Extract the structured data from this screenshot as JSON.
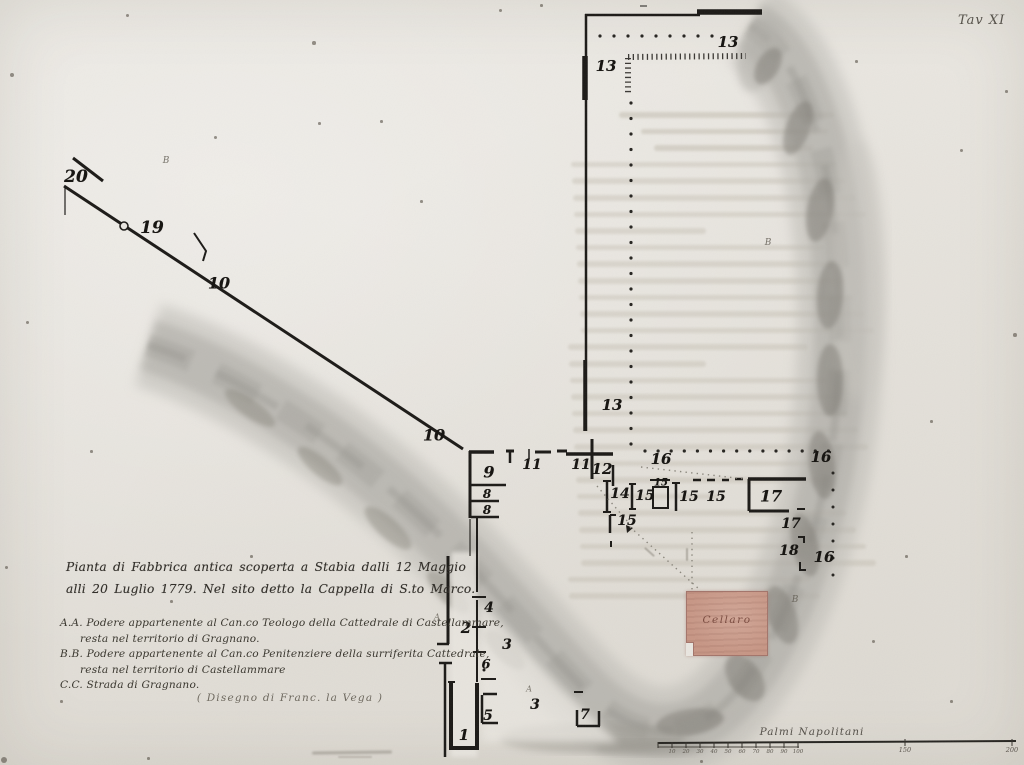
{
  "page": {
    "plate_label": "Tav XI"
  },
  "title_block": {
    "caption_lines": [
      "Pianta di Fabbrica antica scoperta a Stabia dalli 12 Maggio",
      "alli 20 Luglio 1779. Nel sito detto la Cappella di S.to Marco."
    ],
    "legend_lines": [
      {
        "text": "A.A. Podere appartenente al Can.co Teologo della Cattedrale di Castellammare,",
        "indent": false
      },
      {
        "text": "resta nel territorio di Gragnano.",
        "indent": true
      },
      {
        "text": "B.B. Podere appartenente al Can.co Penitenziere della surriferita Cattedrale,",
        "indent": false
      },
      {
        "text": "resta nel territorio di Castellammare",
        "indent": true
      },
      {
        "text": "C.C. Strada di Gragnano.",
        "indent": false
      }
    ],
    "credit": "( Disegno di Franc. la Vega )"
  },
  "plan": {
    "area_label": "Cellaro",
    "room_numbers": [
      {
        "text": "20",
        "x": 76,
        "y": 177,
        "size": 17
      },
      {
        "text": "19",
        "x": 152,
        "y": 228,
        "size": 17
      },
      {
        "text": "10",
        "x": 219,
        "y": 283,
        "size": 16
      },
      {
        "text": "10",
        "x": 434,
        "y": 435,
        "size": 16
      },
      {
        "text": "13",
        "x": 728,
        "y": 42,
        "size": 15
      },
      {
        "text": "13",
        "x": 606,
        "y": 66,
        "size": 15
      },
      {
        "text": "13",
        "x": 612,
        "y": 405,
        "size": 15
      },
      {
        "text": "9",
        "x": 489,
        "y": 472,
        "size": 16
      },
      {
        "text": "11",
        "x": 532,
        "y": 465,
        "size": 14
      },
      {
        "text": "11",
        "x": 581,
        "y": 465,
        "size": 14
      },
      {
        "text": "12",
        "x": 602,
        "y": 469,
        "size": 15
      },
      {
        "text": "8",
        "x": 487,
        "y": 494,
        "size": 12
      },
      {
        "text": "8",
        "x": 487,
        "y": 510,
        "size": 12
      },
      {
        "text": "16",
        "x": 661,
        "y": 459,
        "size": 15
      },
      {
        "text": "16",
        "x": 821,
        "y": 457,
        "size": 15
      },
      {
        "text": "16",
        "x": 824,
        "y": 557,
        "size": 15
      },
      {
        "text": "14",
        "x": 620,
        "y": 494,
        "size": 14
      },
      {
        "text": "15",
        "x": 645,
        "y": 496,
        "size": 14
      },
      {
        "text": "15",
        "x": 661,
        "y": 483,
        "size": 10
      },
      {
        "text": "15",
        "x": 689,
        "y": 497,
        "size": 14
      },
      {
        "text": "15",
        "x": 716,
        "y": 497,
        "size": 14
      },
      {
        "text": "15",
        "x": 627,
        "y": 521,
        "size": 14
      },
      {
        "text": "17",
        "x": 771,
        "y": 496,
        "size": 16
      },
      {
        "text": "17",
        "x": 791,
        "y": 524,
        "size": 14
      },
      {
        "text": "18",
        "x": 789,
        "y": 551,
        "size": 14
      },
      {
        "text": "4",
        "x": 489,
        "y": 608,
        "size": 14
      },
      {
        "text": "2",
        "x": 466,
        "y": 628,
        "size": 15
      },
      {
        "text": "3",
        "x": 507,
        "y": 645,
        "size": 14
      },
      {
        "text": "6",
        "x": 486,
        "y": 665,
        "size": 13
      },
      {
        "text": "5",
        "x": 488,
        "y": 716,
        "size": 14
      },
      {
        "text": "1",
        "x": 464,
        "y": 735,
        "size": 15
      },
      {
        "text": "3",
        "x": 535,
        "y": 705,
        "size": 14
      },
      {
        "text": "7",
        "x": 585,
        "y": 715,
        "size": 14
      }
    ],
    "letter_labels": [
      {
        "text": "B",
        "x": 166,
        "y": 161,
        "size": 9
      },
      {
        "text": "B",
        "x": 768,
        "y": 243,
        "size": 9
      },
      {
        "text": "B",
        "x": 795,
        "y": 600,
        "size": 9
      },
      {
        "text": "A",
        "x": 437,
        "y": 617,
        "size": 8
      },
      {
        "text": "A",
        "x": 529,
        "y": 689,
        "size": 8
      }
    ]
  },
  "scale_bar": {
    "title": "Palmi Napolitani",
    "minor_labels": [
      "10",
      "20",
      "30",
      "40",
      "50",
      "60",
      "70",
      "80",
      "90",
      "100"
    ],
    "major_labels": [
      {
        "text": "150"
      },
      {
        "text": "200"
      }
    ]
  },
  "colors": {
    "ink": "#1b1916",
    "pencil": "#aeaca6",
    "paper": "#e9e6e0",
    "cellaro_fill": "#c79685",
    "cellaro_text": "#7a4b3f"
  }
}
